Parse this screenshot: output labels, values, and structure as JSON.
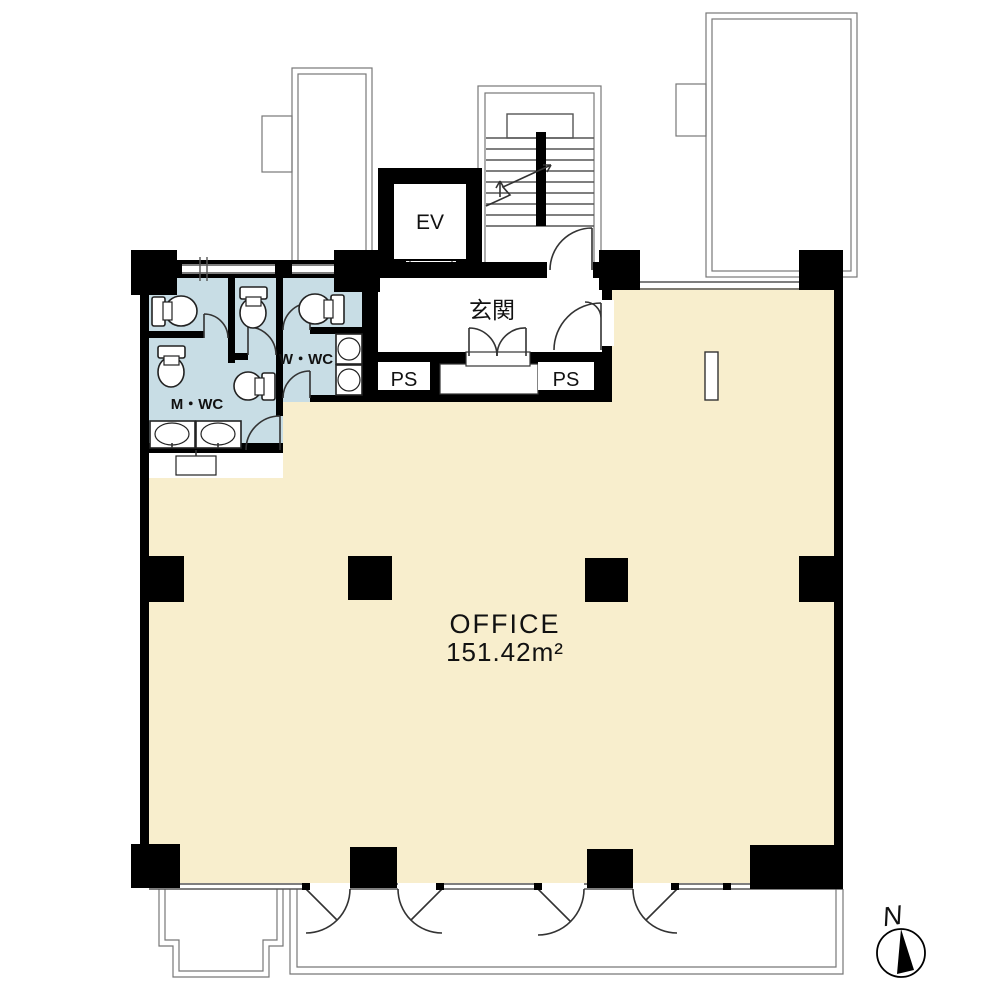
{
  "plan": {
    "rooms": {
      "office": {
        "name": "OFFICE",
        "area": "151.42m²"
      },
      "entrance": {
        "name": "玄関"
      },
      "elevator": {
        "name": "EV"
      },
      "ps_left": {
        "name": "PS"
      },
      "ps_right": {
        "name": "PS"
      },
      "wc_women": {
        "name": "W・WC"
      },
      "wc_men": {
        "name": "M・WC"
      }
    },
    "compass": {
      "north": "N"
    },
    "colors": {
      "office_floor": "#F8EECD",
      "wc_floor": "#C8DDE5",
      "wall": "#000000",
      "outline": "#666666"
    }
  }
}
